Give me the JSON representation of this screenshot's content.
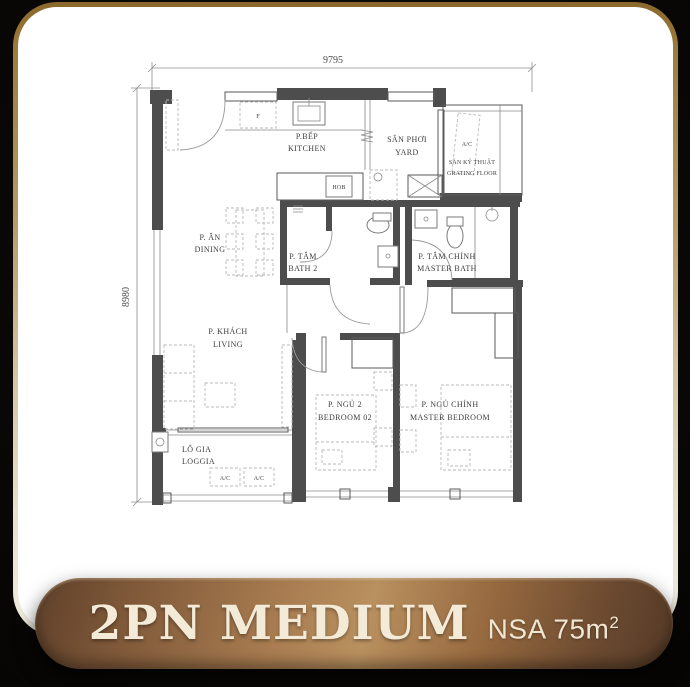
{
  "banner": {
    "title": "2PN MEDIUM",
    "nsa": "NSA 75m",
    "nsa_sup": "2"
  },
  "dimensions": {
    "top": "9795",
    "left": "8980"
  },
  "rooms": {
    "kitchen": {
      "vi": "P.BẾP",
      "en": "KITCHEN"
    },
    "yard": {
      "vi": "SÂN PHƠI",
      "en": "YARD"
    },
    "grating": {
      "vi": "SÀN KỸ THUẬT",
      "en": "GRATING FLOOR"
    },
    "ac_ledge": {
      "label": "A/C"
    },
    "dining": {
      "vi": "P. ĂN",
      "en": "DINING"
    },
    "bath2": {
      "vi": "P. TẮM",
      "en": "BATH 2"
    },
    "master_bath": {
      "vi": "P. TẮM CHÍNH",
      "en": "MASTER BATH"
    },
    "living": {
      "vi": "P. KHÁCH",
      "en": "LIVING"
    },
    "bedroom2": {
      "vi": "P. NGỦ 2",
      "en": "BEDROOM 02"
    },
    "master_bedroom": {
      "vi": "P. NGỦ CHÍNH",
      "en": "MASTER BEDROOM"
    },
    "loggia": {
      "vi": "LÔ GIA",
      "en": "LOGGIA"
    }
  },
  "equipment": {
    "hob": "HOB",
    "fridge": "F",
    "ac1": "A/C",
    "ac2": "A/C"
  },
  "colors": {
    "background": "#0a0806",
    "card": "#ffffff",
    "border_gold": "#96752f",
    "wall": "#4d4d4d",
    "banner_light": "#b9905f",
    "banner_dark": "#5e402a",
    "banner_text": "#f3ead8"
  }
}
